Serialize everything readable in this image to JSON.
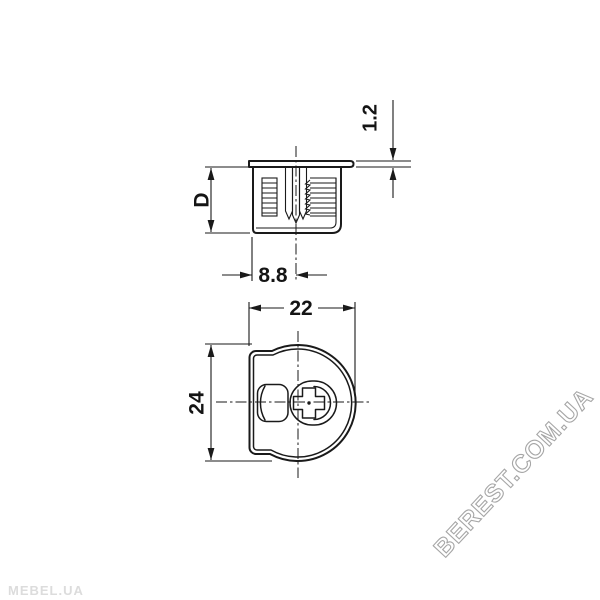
{
  "drawing": {
    "kind": "technical drawing of furniture cam connector fitting",
    "views": {
      "side_view_name": "side section view",
      "front_view_name": "front view"
    }
  },
  "dimensions": {
    "side_view": {
      "flange_thickness": "1.2",
      "body_height": "D",
      "edge_to_axis": "8.8"
    },
    "front_view": {
      "width": "22",
      "diameter": "24"
    }
  },
  "watermarks": {
    "bottom_left": "MEBEL.UA",
    "diagonal_right": "BEREST.COM.UA"
  },
  "colors": {
    "background": "#ffffff",
    "line": "#1a1a1a",
    "watermark_light": "#dcdcdc",
    "watermark_outline": "#a6a6a6"
  }
}
